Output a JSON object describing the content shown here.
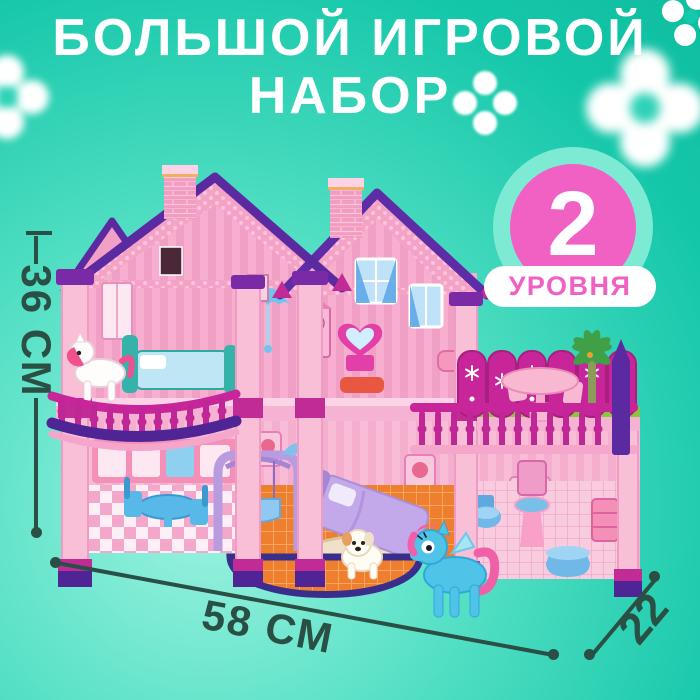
{
  "title": {
    "line1": "БОЛЬШОЙ ИГРОВОЙ",
    "line2": "НАБОР"
  },
  "badge": {
    "value": "2",
    "label": "УРОВНЯ"
  },
  "dimensions": {
    "height": {
      "label": "36 СМ"
    },
    "width": {
      "label": "58 СМ"
    },
    "depth": {
      "label": "22"
    }
  },
  "image": {
    "subject": "two-story pink dollhouse playset",
    "figure_icons": [
      "white-pony-icon",
      "blue-pony-icon",
      "puppy-icon",
      "palm-tree-icon",
      "flower-icon"
    ]
  },
  "colors": {
    "background_teal": "#15C7A9",
    "background_mint": "#9FF3E1",
    "title_text": "#FFFFFF",
    "badge_circle_pink": "#F160C3",
    "badge_ring_mint": "#7DEAD3",
    "badge_number": "#FFFFFF",
    "badge_pill_bg": "#FFFFFF",
    "badge_label_pink": "#F160C3",
    "measure_green": "#2A4F44",
    "house_pink": "#F6A8CC",
    "house_magenta": "#C4299A",
    "house_purple": "#5B2AA0",
    "flower_white": "#FFFFFF"
  }
}
